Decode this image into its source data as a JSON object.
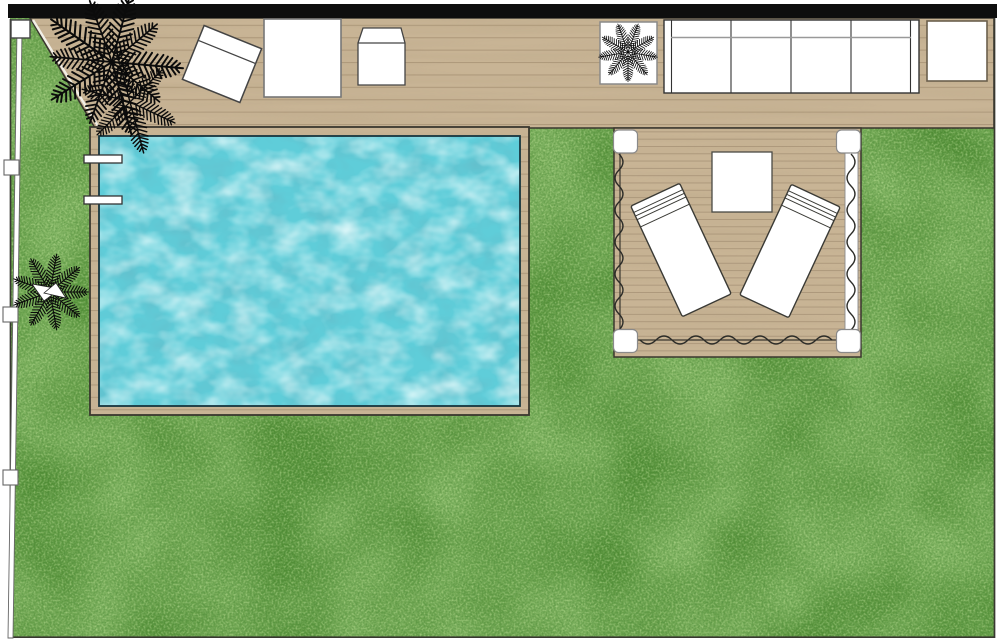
{
  "scene": {
    "title": "Backyard landscape plan with pool, deck, pergola and lawn"
  },
  "labels": {
    "lawn": "Lawn",
    "deck": "Wood deck",
    "wall": "Wall",
    "fence": "Fence",
    "pool": "Swimming pool",
    "water": "Pool water",
    "ladder": "Pool ladder",
    "pergola": "Pergola deck with curtains",
    "curtain": "Curtain",
    "palm_large": "Palm tree",
    "garden_plant": "Garden palm plant",
    "potted_plant": "Potted plant",
    "chair": "Deck chair",
    "table": "Outdoor table",
    "armchair": "Armchair",
    "sofa": "Outdoor sofa",
    "side_table": "Side table",
    "coffee_table": "Pergola table",
    "lounger_left": "Sun lounger (left)",
    "lounger_right": "Sun lounger (right)"
  },
  "colors": {
    "wall": "#0e0e0e",
    "deck": "#c8b495",
    "deck_line": "#ab967a",
    "grass_base": "#4f8c33",
    "water_base": "#5fcdd9",
    "furniture_fill": "#ffffff",
    "outline_dark": "#3a372f",
    "fence_white": "#ffffff",
    "plant_black": "#0b0b0b"
  }
}
